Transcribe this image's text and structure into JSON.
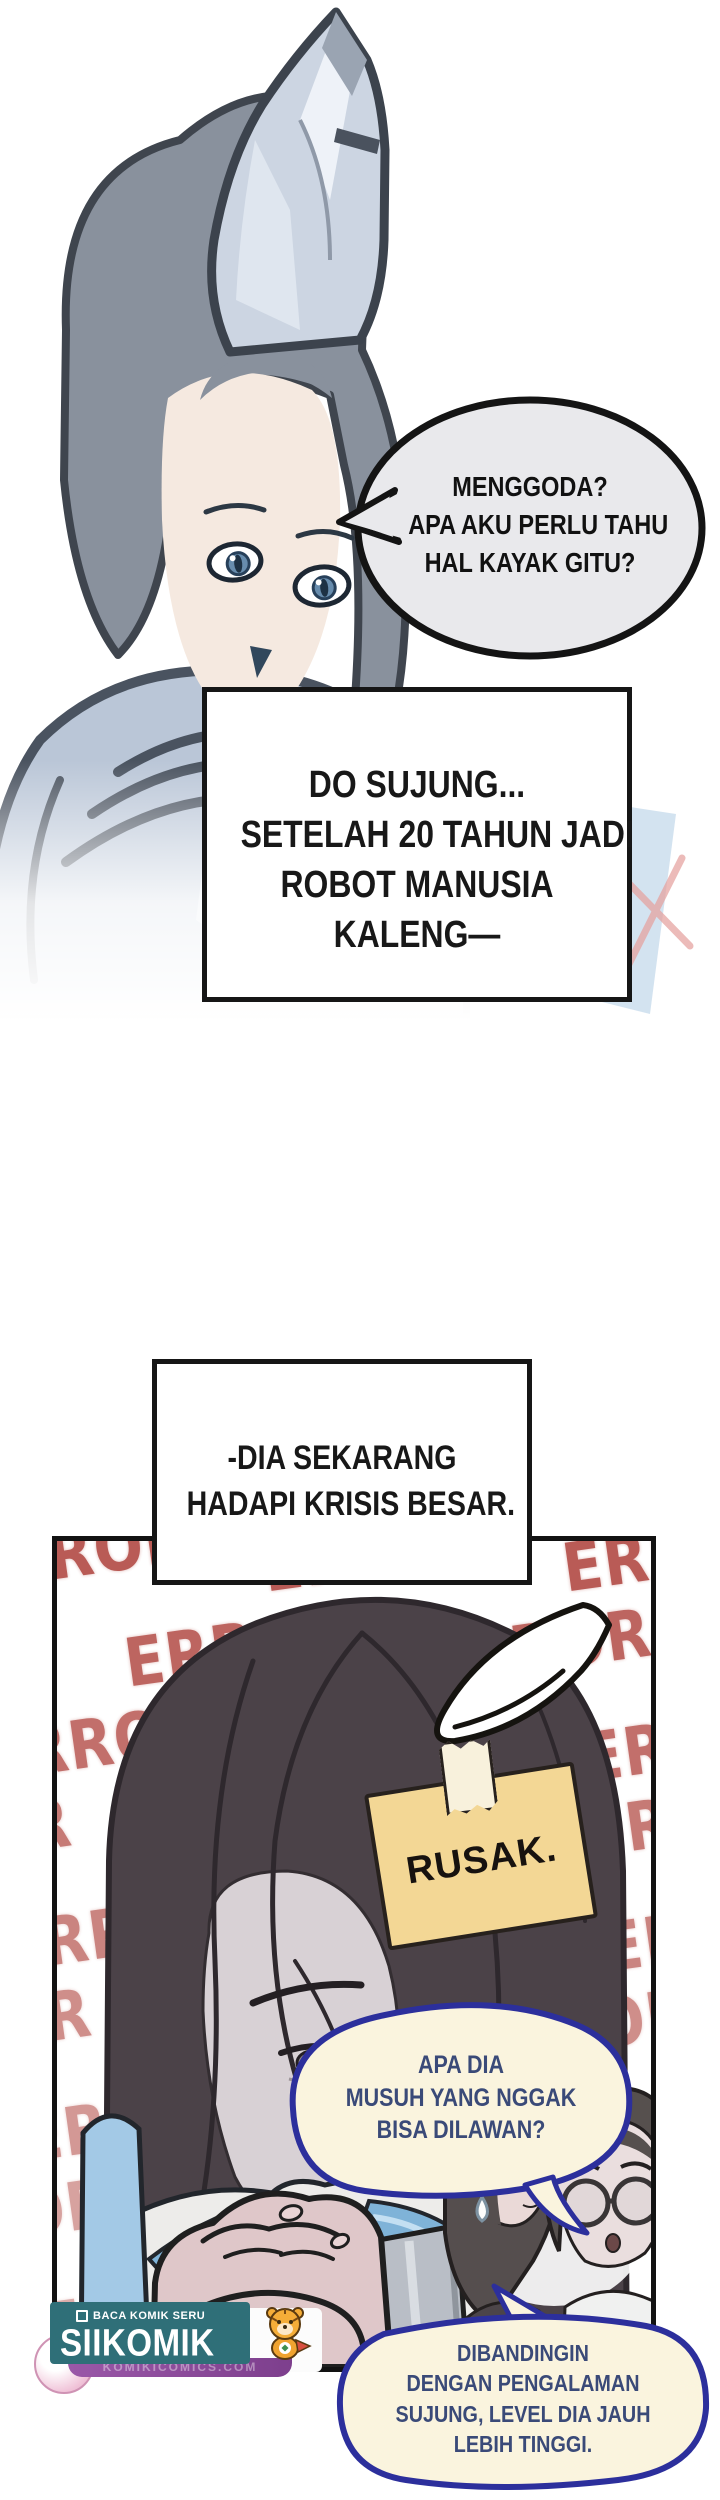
{
  "top_scene": {
    "bubble_lines": [
      "MENGGODA?",
      "APA AKU PERLU TAHU",
      "HAL KAYAK GITU?"
    ]
  },
  "narration": {
    "box1_lines": [
      "DO SUJUNG...",
      "SETELAH 20 TAHUN JADI",
      "ROBOT MANUSIA",
      "KALENG—"
    ],
    "box2_lines": [
      "-DIA SEKARANG",
      "HADAPI KRISIS BESAR."
    ]
  },
  "panel": {
    "error_word": "ERROR",
    "note_text": "RUSAK.",
    "question_bubble_lines": [
      "APA DIA",
      "MUSUH YANG NGGAK",
      "BISA DILAWAN?"
    ],
    "answer_bubble_lines": [
      "DIBANDINGIN",
      "DENGAN PENGALAMAN",
      "SUJUNG, LEVEL DIA JAUH",
      "LEBIH TINGGI."
    ]
  },
  "watermark": {
    "tagline": "BACA KOMIK SERU",
    "brand": "SIIKOMIK",
    "url_text": "KOMIKICOMICS.COM"
  },
  "colors": {
    "error_red": "#b0453f",
    "bubble_border_navy": "#2c2f9c",
    "bubble_fill_cream": "#faf4de",
    "bubble_text_navy": "#3a4a78",
    "note_tan": "#f3d795",
    "badge_teal": "#2f6f78",
    "badge_purple": "#8d4b9b",
    "grey_bubble_fill": "#e9e9ec"
  }
}
